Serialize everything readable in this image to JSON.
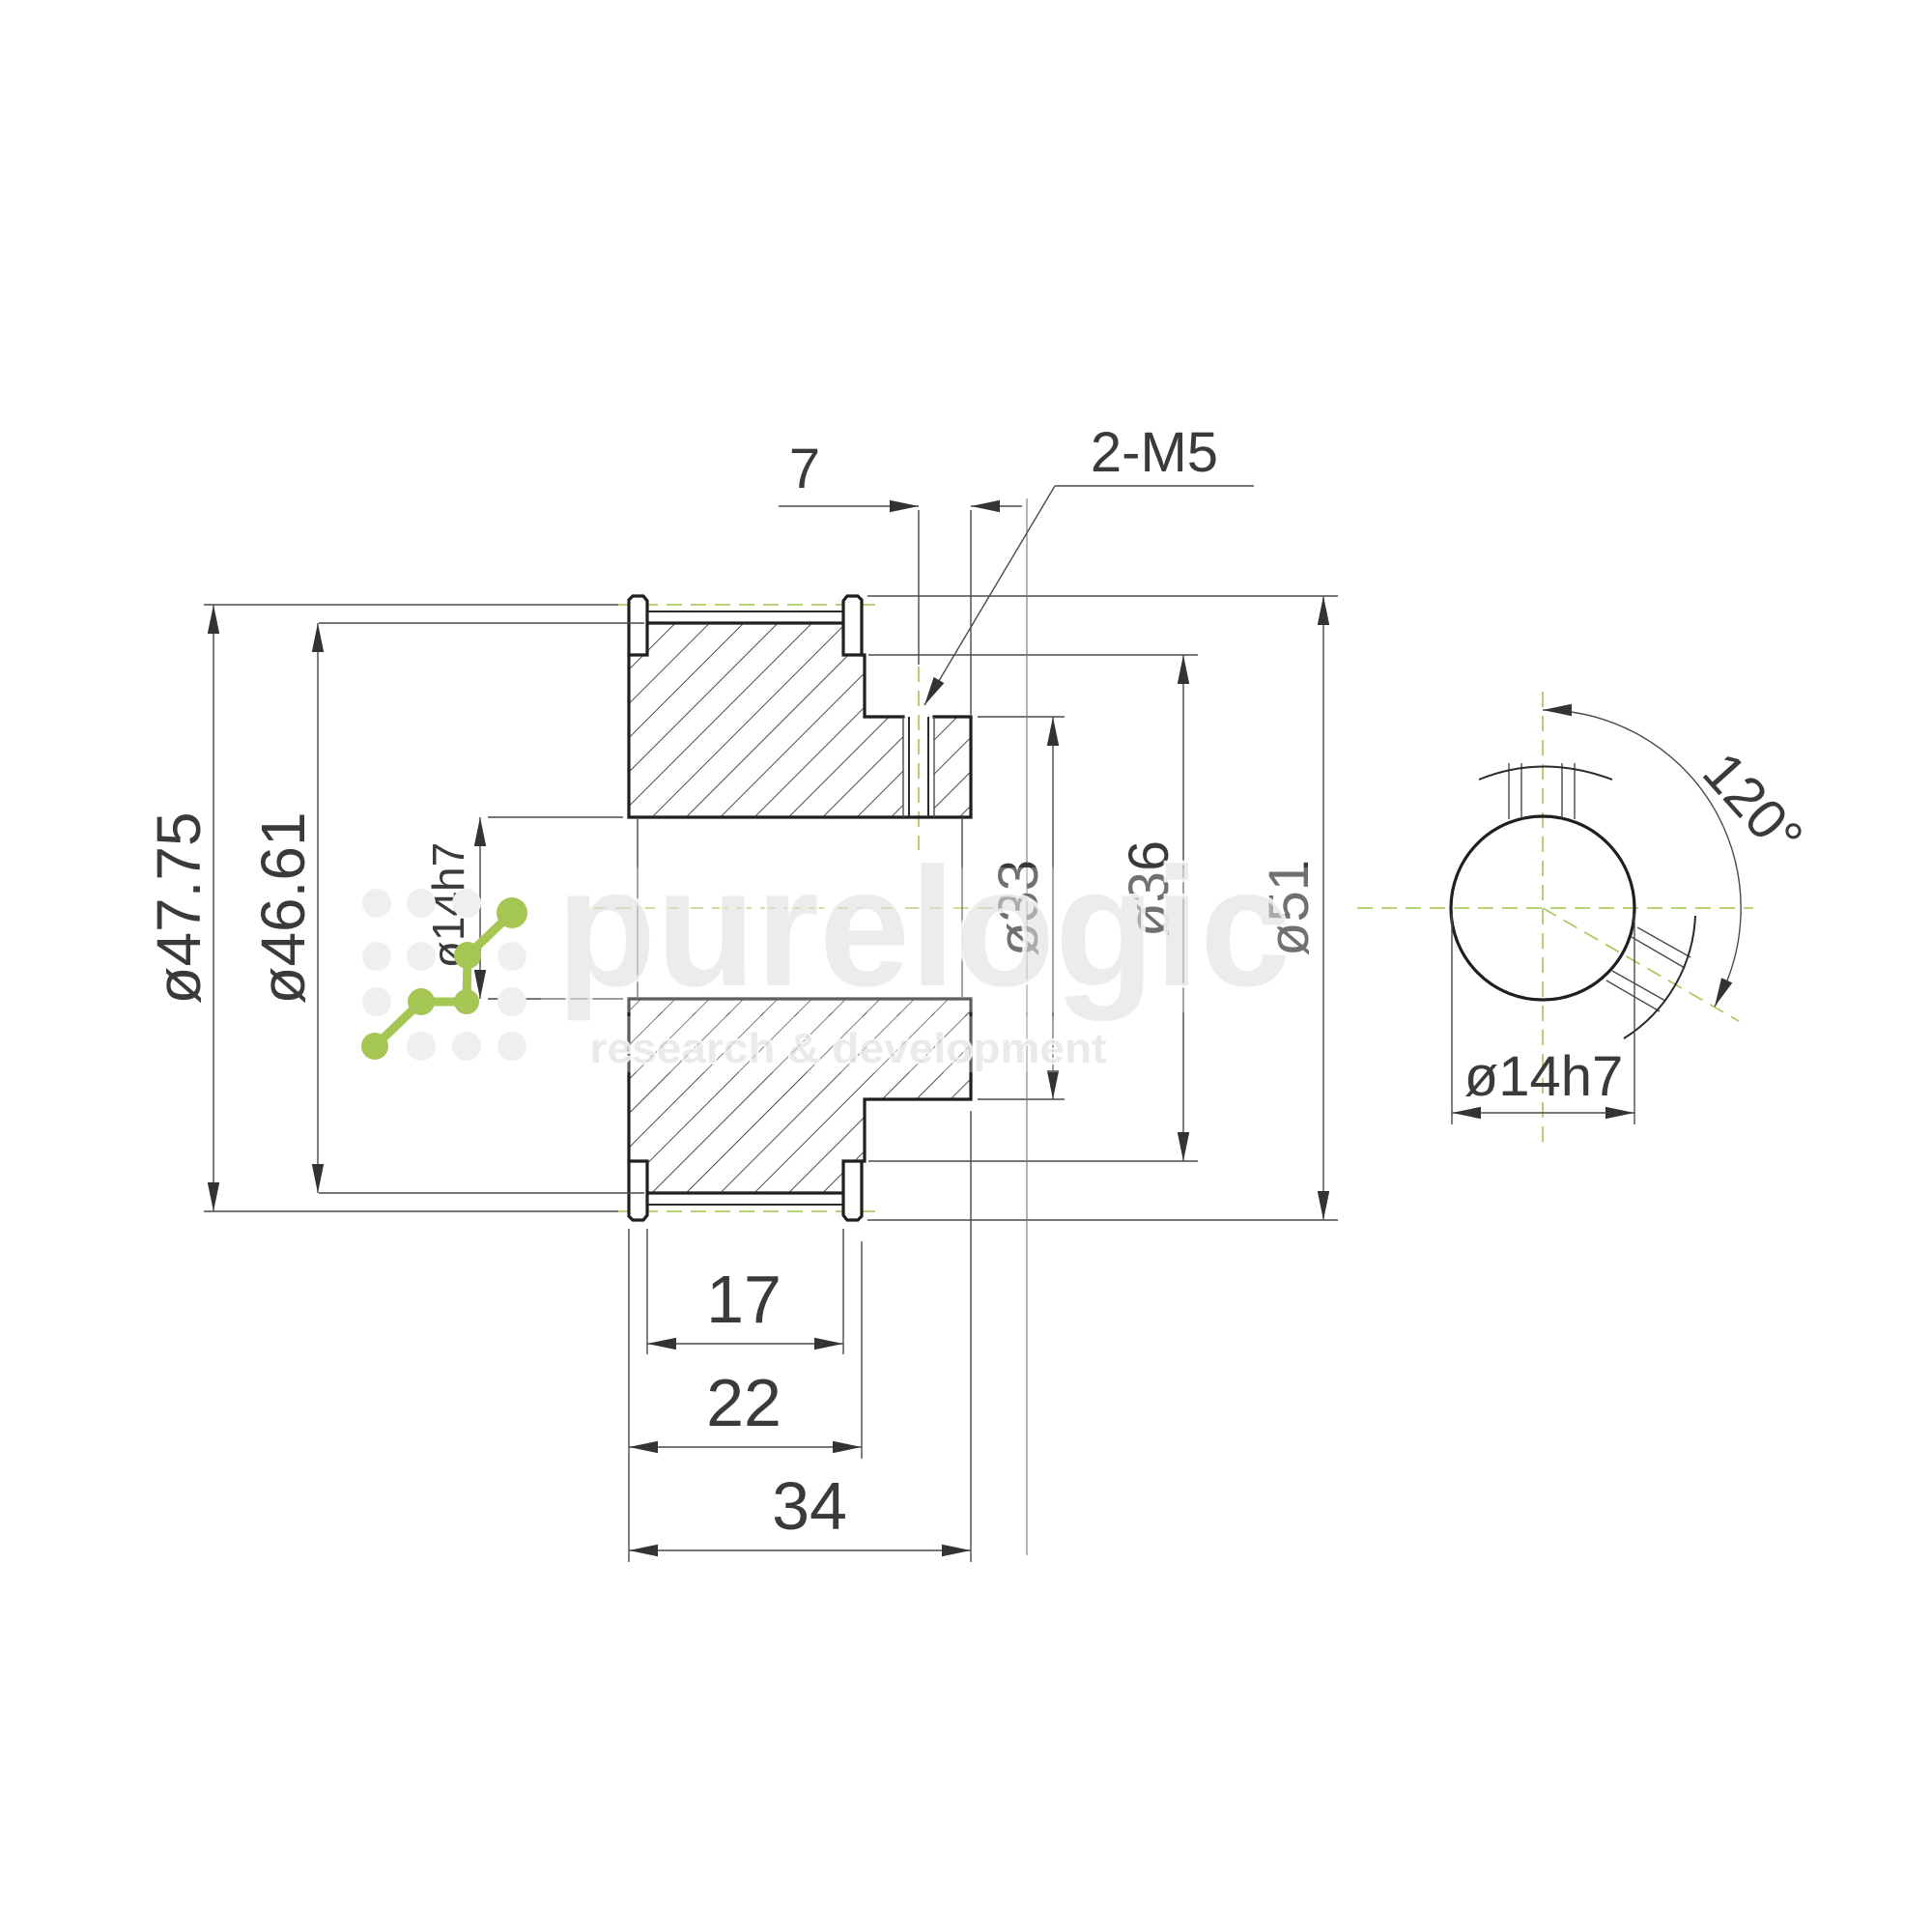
{
  "drawing": {
    "type": "technical-drawing",
    "part": "timing pulley section and end view"
  },
  "dims": {
    "pitch_diameter": "ø47.75",
    "outer_diameter": "ø46.61",
    "bore_side": "ø14h7",
    "screw_offset": "7",
    "screw_thread": "2-M5",
    "hub_diameter": "ø33",
    "shoulder_diameter": "ø36",
    "flange_diameter": "ø51",
    "belt_width": "17",
    "body_width": "22",
    "total_width": "34",
    "screw_angle": "120°",
    "bore_end": "ø14h7"
  },
  "watermark": {
    "title": "purelogic",
    "subtitle": "research & development"
  },
  "colors": {
    "centerline_green": "#aecb63",
    "logo_green": "#a6c653",
    "line_dark": "#1f1f1f",
    "dim_text": "#3a3a3a",
    "watermark_gray": "#dcdcdc"
  }
}
